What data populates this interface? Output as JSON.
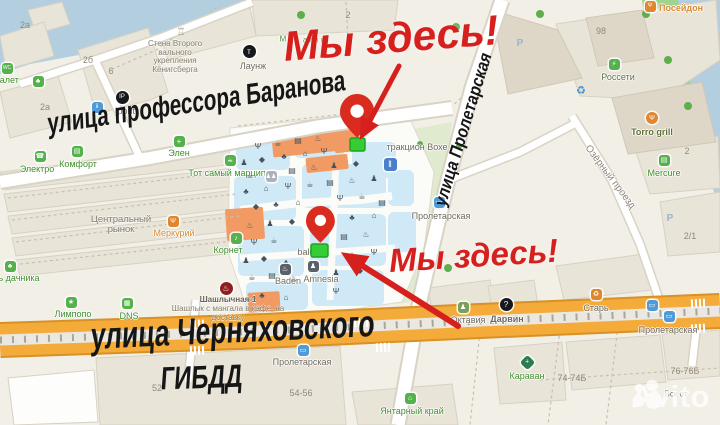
{
  "overlay": {
    "we_are_here_top": "Мы здесь!",
    "we_are_here_bottom": "Мы здесь!"
  },
  "streets": {
    "baranova": "улица профессора Баранова",
    "chernyakhovskogo": "улица Черняховского",
    "gibdd": "ГИБДД",
    "proletarskaya": "улица Пролетарская",
    "ozerny": "Озёрный проезд"
  },
  "watermark": {
    "brand": "Avito"
  },
  "colors": {
    "annotation_red": "#d6201d",
    "marker_green": "#35cc35",
    "road_orange": "#f4ab39",
    "water": "#b3cfdf",
    "park": "#dfeacf",
    "mall_blue": "#cfe9f7",
    "poi_green": "#3f8f2e"
  },
  "pois": [
    {
      "t": "туалет",
      "x": 5,
      "y": 80,
      "c": "c-green",
      "ic": {
        "x": 7,
        "y": 68,
        "bg": "#55b14c",
        "g": "WC",
        "fs": 5
      }
    },
    {
      "t": "Электро",
      "x": 37,
      "y": 169,
      "c": "c-green",
      "ic": {
        "x": 40,
        "y": 156,
        "bg": "#55b14c",
        "g": "☎",
        "fs": 7
      }
    },
    {
      "t": "Комфорт",
      "x": 78,
      "y": 164,
      "c": "c-green",
      "ic": {
        "x": 77,
        "y": 151,
        "bg": "#55b14c",
        "g": "▤",
        "fs": 7
      }
    },
    {
      "t": "Элен",
      "x": 179,
      "y": 153,
      "c": "c-green",
      "ic": {
        "x": 179,
        "y": 141,
        "bg": "#55b14c",
        "g": "+",
        "fs": 8
      }
    },
    {
      "t": "Тот самый марципан",
      "x": 232,
      "y": 173,
      "c": "c-green",
      "ic": {
        "x": 230,
        "y": 160,
        "bg": "#55b14c",
        "g": "☕",
        "fs": 7
      }
    },
    {
      "t": "Меркурий",
      "x": 174,
      "y": 233,
      "c": "c-orange",
      "ic": {
        "x": 173,
        "y": 221,
        "bg": "#e0862e",
        "g": "Ψ",
        "fs": 7
      }
    },
    {
      "t": "Корнет",
      "x": 228,
      "y": 250,
      "c": "c-green",
      "ic": {
        "x": 236,
        "y": 238,
        "bg": "#55b14c",
        "g": "♪",
        "fs": 7
      }
    },
    {
      "t": "Лимпопо",
      "x": 73,
      "y": 314,
      "c": "c-green",
      "ic": {
        "x": 71,
        "y": 302,
        "bg": "#55b14c",
        "g": "★",
        "fs": 7
      }
    },
    {
      "t": "DNS",
      "x": 129,
      "y": 316,
      "c": "c-green",
      "ic": {
        "x": 127,
        "y": 303,
        "bg": "#55b14c",
        "g": "▦",
        "fs": 7
      }
    },
    {
      "t": "ь дачника",
      "x": 19,
      "y": 278,
      "c": "c-green",
      "ic": {
        "x": 10,
        "y": 266,
        "bg": "#55b14c",
        "g": "♣",
        "fs": 7
      }
    },
    {
      "t": "Baden",
      "x": 288,
      "y": 281,
      "c": "c-brown",
      "ic": {
        "x": 285,
        "y": 269,
        "bg": "#5a6069",
        "g": "♨",
        "fs": 7
      }
    },
    {
      "t": "Amnesia",
      "x": 321,
      "y": 279,
      "c": "c-brown",
      "ic": {
        "x": 313,
        "y": 266,
        "bg": "#5a6069",
        "g": "♟",
        "fs": 7
      }
    },
    {
      "t": "Октавия",
      "x": 468,
      "y": 320,
      "c": "c-gray",
      "ic": {
        "x": 463,
        "y": 307,
        "bg": "#7aa05c",
        "g": "♟",
        "fs": 7
      }
    },
    {
      "t": "Дарвин",
      "x": 507,
      "y": 319,
      "c": "c-gray",
      "fw": "700",
      "ic": {
        "x": 506,
        "y": 304,
        "bg": "#17181c",
        "g": "?",
        "s": "c",
        "sz": 13,
        "fs": 8
      }
    },
    {
      "t": "Старь",
      "x": 596,
      "y": 308,
      "c": "c-gray",
      "ic": {
        "x": 596,
        "y": 294,
        "bg": "#e0862e",
        "g": "♻",
        "fs": 7
      }
    },
    {
      "t": "Караван",
      "x": 527,
      "y": 376,
      "c": "c-green",
      "ic": {
        "x": 527,
        "y": 362,
        "bg": "#2e7d4f",
        "g": "+",
        "s": "d",
        "fs": 7
      }
    },
    {
      "t": "Янтарный край",
      "x": 412,
      "y": 411,
      "c": "c-green",
      "ic": {
        "x": 410,
        "y": 398,
        "bg": "#55b14c",
        "g": "⌂",
        "fs": 7
      }
    },
    {
      "t": "Mercure",
      "x": 664,
      "y": 173,
      "c": "c-green",
      "ic": {
        "x": 664,
        "y": 160,
        "bg": "#55b14c",
        "g": "▤",
        "fs": 7
      }
    },
    {
      "t": "Torro grill",
      "x": 652,
      "y": 132,
      "c": "c-olive",
      "fw": "700",
      "ic": {
        "x": 652,
        "y": 118,
        "bg": "#e0862e",
        "g": "Ψ",
        "s": "c",
        "sz": 12,
        "fs": 7
      }
    },
    {
      "t": "Россети",
      "x": 618,
      "y": 77,
      "c": "c-graygreen",
      "ic": {
        "x": 614,
        "y": 64,
        "bg": "#55b14c",
        "g": "⚡",
        "fs": 7
      }
    },
    {
      "t": "Посейдон",
      "x": 681,
      "y": 8,
      "c": "c-orange",
      "fw": "700",
      "ic": {
        "x": 650,
        "y": 6,
        "bg": "#e0862e",
        "g": "Ψ",
        "fs": 6
      }
    },
    {
      "t": "Лаунж",
      "x": 253,
      "y": 66,
      "c": "c-gray",
      "ic": {
        "x": 249,
        "y": 51,
        "bg": "#17181c",
        "g": "т",
        "s": "c",
        "sz": 13,
        "fs": 8
      }
    },
    {
      "t": "Ipont",
      "x": 125,
      "y": 111,
      "c": "c-gray",
      "ic": {
        "x": 122,
        "y": 97,
        "bg": "#17181c",
        "g": "IP",
        "s": "c",
        "sz": 13,
        "fs": 6
      }
    },
    {
      "t": "тракцион Вохе",
      "x": 417,
      "y": 147,
      "c": "c-gray"
    },
    {
      "t": "balu",
      "x": 306,
      "y": 252,
      "c": "c-gray"
    },
    {
      "t": "Пролетарская",
      "x": 441,
      "y": 216,
      "c": "c-gray",
      "ic": {
        "x": 439,
        "y": 202,
        "bg": "#4f9bd8",
        "g": "▭",
        "fs": 7
      }
    },
    {
      "t": "Пролетарская",
      "x": 302,
      "y": 362,
      "c": "c-gray",
      "ic": {
        "x": 303,
        "y": 350,
        "bg": "#4f9bd8",
        "g": "▭",
        "fs": 7
      }
    },
    {
      "t": "Пролетарская",
      "x": 668,
      "y": 330,
      "c": "c-gray",
      "ic": {
        "x": 669,
        "y": 316,
        "bg": "#4f9bd8",
        "g": "▭",
        "fs": 7
      }
    },
    {
      "t": "М",
      "x": 283,
      "y": 39,
      "c": "c-green",
      "fs": 8
    },
    {
      "t": "амы в",
      "x": 314,
      "y": 40,
      "c": "c-green",
      "fs": 8
    },
    {
      "t": "И",
      "x": 290,
      "y": 49,
      "c": "c-green",
      "fs": 8
    },
    {
      "t": "Вск от",
      "x": 676,
      "y": 394,
      "c": "c-gray",
      "fs": 8
    },
    {
      "t": "2а",
      "x": 25,
      "y": 25,
      "c": "num"
    },
    {
      "t": "2б",
      "x": 88,
      "y": 60,
      "c": "num"
    },
    {
      "t": "6",
      "x": 111,
      "y": 71,
      "c": "num"
    },
    {
      "t": "2а",
      "x": 45,
      "y": 107,
      "c": "num"
    },
    {
      "t": "2",
      "x": 348,
      "y": 15,
      "c": "num"
    },
    {
      "t": "98",
      "x": 601,
      "y": 31,
      "c": "num"
    },
    {
      "t": "2",
      "x": 687,
      "y": 151,
      "c": "num"
    },
    {
      "t": "2/1",
      "x": 690,
      "y": 236,
      "c": "num"
    },
    {
      "t": "52",
      "x": 157,
      "y": 388,
      "c": "num"
    },
    {
      "t": "54-56",
      "x": 301,
      "y": 393,
      "c": "num"
    },
    {
      "t": "74-74Б",
      "x": 572,
      "y": 378,
      "c": "num"
    },
    {
      "t": "76-76Б",
      "x": 685,
      "y": 371,
      "c": "num"
    }
  ],
  "standalone_icons": [
    {
      "x": 38,
      "y": 81,
      "bg": "#55b14c",
      "g": "♣",
      "fs": 7,
      "name": "paw-icon"
    },
    {
      "x": 97,
      "y": 107,
      "bg": "#4f9bd8",
      "g": "ii",
      "fs": 6,
      "name": "wc-icon"
    },
    {
      "x": 390,
      "y": 164,
      "bg": "#4a7fc9",
      "g": "‖",
      "sz": 13,
      "fs": 9,
      "name": "mall-entrance-icon"
    },
    {
      "x": 652,
      "y": 305,
      "bg": "#4f9bd8",
      "g": "▭",
      "fs": 7,
      "name": "bus-stop-icon"
    },
    {
      "x": 226,
      "y": 288,
      "bg": "#8f1f1f",
      "g": "♨",
      "s": "c",
      "sz": 13,
      "fs": 8,
      "name": "shashlik-icon"
    },
    {
      "x": 581,
      "y": 90,
      "bg": "none",
      "g": "♻",
      "fg": "#3f8fd1",
      "fs": 11,
      "name": "recycling-icon"
    },
    {
      "x": 181,
      "y": 32,
      "bg": "none",
      "g": "♖",
      "fg": "#9a9488",
      "fs": 10,
      "name": "monument-icon"
    },
    {
      "x": 520,
      "y": 43,
      "bg": "none",
      "g": "P",
      "fg": "#9db3cf",
      "fs": 10,
      "fw": "700",
      "name": "parking-icon"
    },
    {
      "x": 670,
      "y": 218,
      "bg": "none",
      "g": "P",
      "fg": "#9db3cf",
      "fs": 10,
      "fw": "700",
      "name": "parking-icon"
    },
    {
      "x": 271,
      "y": 176,
      "bg": "#a9b2bb",
      "g": "♟♟",
      "fs": 6,
      "name": "people-icon"
    }
  ],
  "multiline": [
    {
      "name": "fort-wall-label",
      "x": 175,
      "y": 40,
      "fs": 8,
      "lh": 8.5,
      "lines": [
        "Стена Второго",
        "вального",
        "укрепления",
        "Кёнигсберга"
      ]
    },
    {
      "name": "central-market-label",
      "x": 121,
      "y": 215,
      "fs": 9.5,
      "lh": 10,
      "lines": [
        "Центральный",
        "рынок"
      ]
    },
    {
      "name": "shashlik-label",
      "x": 228,
      "y": 295,
      "fs": 8,
      "lh": 9,
      "strongFirst": true,
      "lines": [
        "Шашлычная-1",
        "Шашлык с мангала в кафе, на",
        "доставку"
      ]
    }
  ],
  "mall_icons": {
    "glyphs": [
      "Ψ",
      "☕",
      "▤",
      "♨",
      "♟",
      "◆",
      "♣",
      "⌂"
    ],
    "points": [
      [
        258,
        147
      ],
      [
        278,
        144
      ],
      [
        298,
        141
      ],
      [
        318,
        139
      ],
      [
        244,
        163
      ],
      [
        262,
        160
      ],
      [
        284,
        157
      ],
      [
        305,
        154
      ],
      [
        324,
        152
      ],
      [
        250,
        176
      ],
      [
        292,
        171
      ],
      [
        314,
        168
      ],
      [
        334,
        166
      ],
      [
        356,
        164
      ],
      [
        246,
        192
      ],
      [
        266,
        189
      ],
      [
        288,
        187
      ],
      [
        310,
        185
      ],
      [
        330,
        183
      ],
      [
        352,
        181
      ],
      [
        374,
        179
      ],
      [
        256,
        207
      ],
      [
        276,
        205
      ],
      [
        298,
        203
      ],
      [
        340,
        199
      ],
      [
        362,
        197
      ],
      [
        382,
        203
      ],
      [
        250,
        226
      ],
      [
        270,
        224
      ],
      [
        292,
        222
      ],
      [
        352,
        218
      ],
      [
        374,
        216
      ],
      [
        254,
        243
      ],
      [
        274,
        241
      ],
      [
        344,
        237
      ],
      [
        366,
        235
      ],
      [
        246,
        261
      ],
      [
        264,
        259
      ],
      [
        286,
        263
      ],
      [
        352,
        255
      ],
      [
        374,
        253
      ],
      [
        252,
        278
      ],
      [
        272,
        276
      ],
      [
        294,
        279
      ],
      [
        336,
        273
      ],
      [
        360,
        271
      ],
      [
        262,
        296
      ],
      [
        286,
        298
      ],
      [
        336,
        292
      ]
    ]
  }
}
